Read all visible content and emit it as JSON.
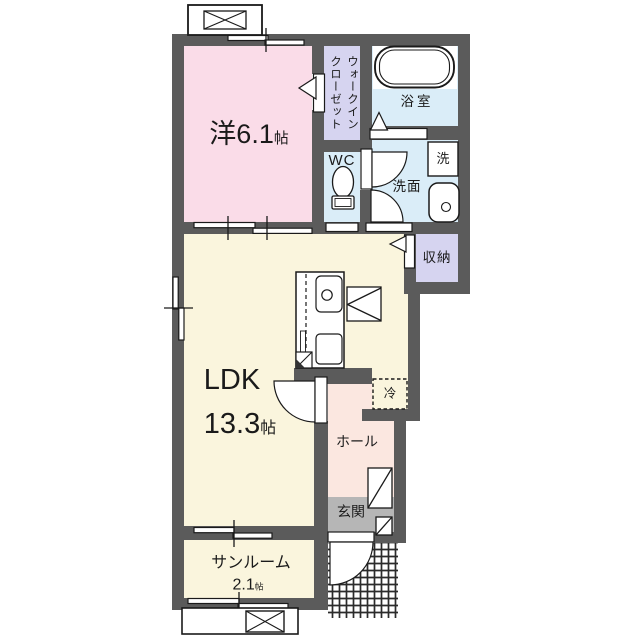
{
  "rooms": {
    "western": {
      "name": "洋6.1",
      "unit": "帖"
    },
    "wic": {
      "line1": "ウォークイン",
      "line2": "クローゼット"
    },
    "wc": {
      "label": "WC"
    },
    "bath": {
      "label": "浴室"
    },
    "washer": {
      "label": "洗"
    },
    "washroom": {
      "label": "洗面"
    },
    "storage": {
      "label": "収納"
    },
    "ldk": {
      "name": "LDK",
      "size": "13.3",
      "unit": "帖"
    },
    "fridge": {
      "label": "冷"
    },
    "hall": {
      "label": "ホール"
    },
    "entrance": {
      "label": "玄関"
    },
    "sunroom": {
      "name": "サンルーム",
      "size": "2.1",
      "unit": "帖"
    }
  },
  "colors": {
    "wall": "#5b5b5b",
    "western": "#fadce8",
    "closet": "#d6d4f0",
    "wet": "#daedf8",
    "ldk": "#faf5dd",
    "hall": "#fbe7e0",
    "entrance": "#b6b6b6",
    "line": "#1a1a1a",
    "bg": "#ffffff"
  }
}
